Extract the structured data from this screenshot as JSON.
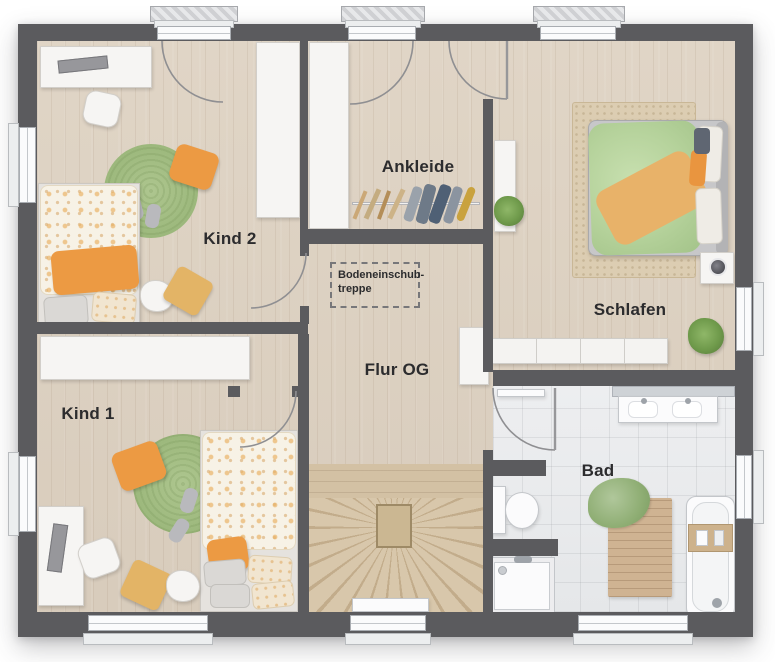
{
  "rooms": {
    "kind2": {
      "label": "Kind 2"
    },
    "kind1": {
      "label": "Kind 1"
    },
    "ankleide": {
      "label": "Ankleide"
    },
    "schlafen": {
      "label": "Schlafen"
    },
    "flur": {
      "label": "Flur OG"
    },
    "bad": {
      "label": "Bad"
    }
  },
  "annotations": {
    "attic_stairs": {
      "line1": "Bodeneinschub-",
      "line2": "treppe"
    }
  },
  "colors": {
    "wall": "#5b5b5e",
    "floor_wood": "#ddd1c2",
    "floor_tile": "#e9eaec",
    "stair_wood": "#cdb995",
    "rug_green": "#a3bd85",
    "rug_beige": "#dbcbb0",
    "accent_orange": "#ec9a43",
    "cushion_yellow": "#e3b466",
    "plant_green": "#72a04e",
    "window_frame": "#fbfbfc"
  }
}
